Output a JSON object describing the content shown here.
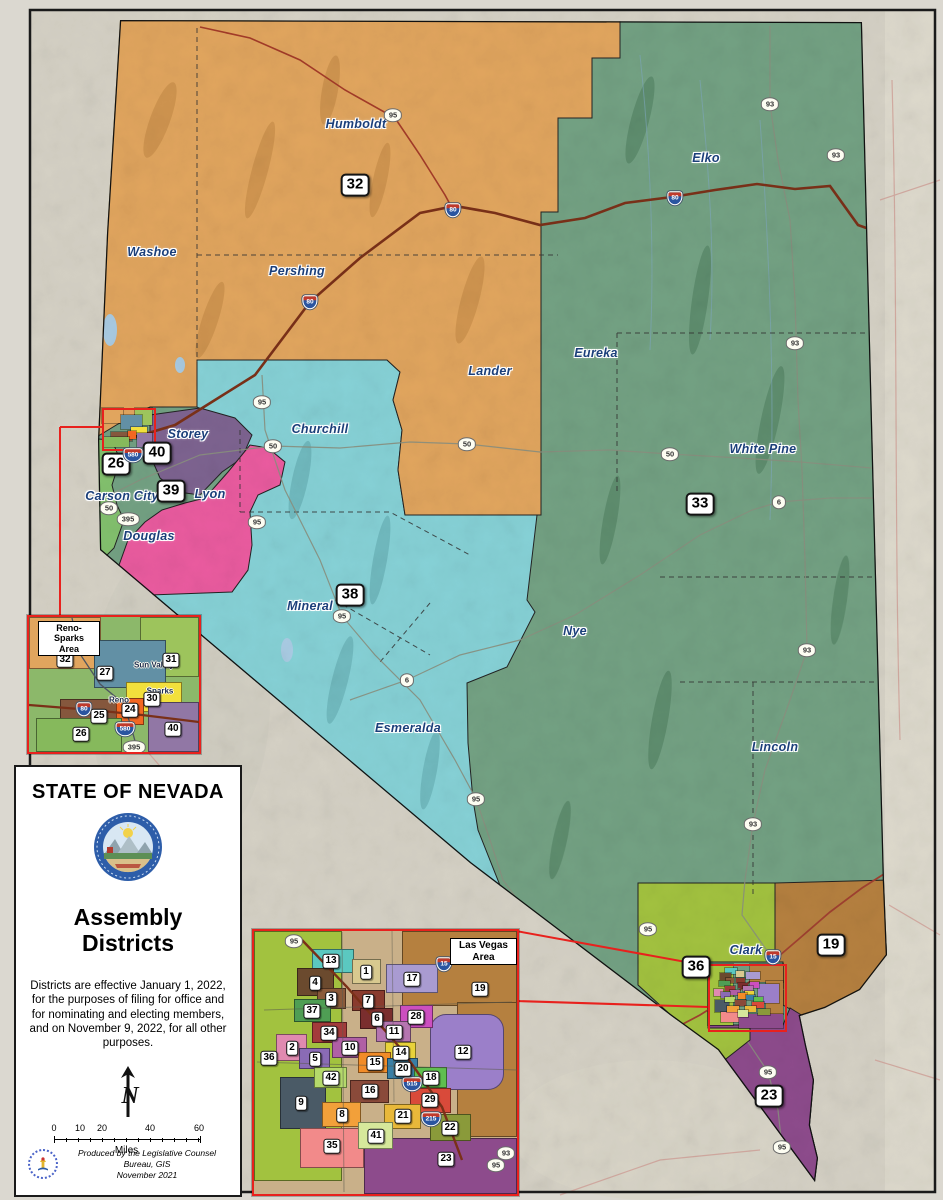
{
  "title_block": {
    "state_title": "STATE OF NEVADA",
    "map_title_line1": "Assembly",
    "map_title_line2": "Districts",
    "note": "Districts are effective January 1, 2022, for the purposes of filing for office and for nominating and electing members, and on November 9, 2022, for all other purposes.",
    "north_label": "N",
    "scale_ticks": [
      {
        "t": "0",
        "x": 38
      },
      {
        "t": "10",
        "x": 64
      },
      {
        "t": "20",
        "x": 86
      },
      {
        "t": "40",
        "x": 134
      },
      {
        "t": "60",
        "x": 183
      }
    ],
    "scale_unit": "Miles",
    "credit_line1": "Produced by the Legislative Counsel Bureau, GIS",
    "credit_line2": "November 2021"
  },
  "main_map": {
    "county_labels": [
      {
        "text": "Humboldt",
        "x": 356,
        "y": 124
      },
      {
        "text": "Washoe",
        "x": 152,
        "y": 252
      },
      {
        "text": "Pershing",
        "x": 297,
        "y": 271
      },
      {
        "text": "Elko",
        "x": 706,
        "y": 158
      },
      {
        "text": "Lander",
        "x": 490,
        "y": 371
      },
      {
        "text": "Eureka",
        "x": 596,
        "y": 353
      },
      {
        "text": "Churchill",
        "x": 320,
        "y": 429
      },
      {
        "text": "White Pine",
        "x": 763,
        "y": 449
      },
      {
        "text": "Storey",
        "x": 188,
        "y": 434
      },
      {
        "text": "Carson City",
        "x": 122,
        "y": 496
      },
      {
        "text": "Lyon",
        "x": 210,
        "y": 494
      },
      {
        "text": "Douglas",
        "x": 149,
        "y": 536
      },
      {
        "text": "Mineral",
        "x": 310,
        "y": 606
      },
      {
        "text": "Nye",
        "x": 575,
        "y": 631
      },
      {
        "text": "Esmeralda",
        "x": 408,
        "y": 728
      },
      {
        "text": "Lincoln",
        "x": 775,
        "y": 747
      },
      {
        "text": "Clark",
        "x": 746,
        "y": 950
      }
    ],
    "district_badges": [
      {
        "n": "32",
        "x": 355,
        "y": 185
      },
      {
        "n": "26",
        "x": 116,
        "y": 464
      },
      {
        "n": "40",
        "x": 157,
        "y": 453
      },
      {
        "n": "39",
        "x": 171,
        "y": 491
      },
      {
        "n": "38",
        "x": 350,
        "y": 595
      },
      {
        "n": "33",
        "x": 700,
        "y": 504
      },
      {
        "n": "36",
        "x": 696,
        "y": 967
      },
      {
        "n": "19",
        "x": 831,
        "y": 945
      },
      {
        "n": "23",
        "x": 769,
        "y": 1096
      }
    ],
    "shields": [
      {
        "t": "95",
        "k": "us",
        "x": 393,
        "y": 115
      },
      {
        "t": "95",
        "k": "us",
        "x": 262,
        "y": 402
      },
      {
        "t": "95",
        "k": "us",
        "x": 257,
        "y": 522
      },
      {
        "t": "95",
        "k": "us",
        "x": 342,
        "y": 616
      },
      {
        "t": "95",
        "k": "us",
        "x": 476,
        "y": 799
      },
      {
        "t": "95",
        "k": "us",
        "x": 648,
        "y": 929
      },
      {
        "t": "95",
        "k": "us",
        "x": 768,
        "y": 1072
      },
      {
        "t": "95",
        "k": "us",
        "x": 782,
        "y": 1147
      },
      {
        "t": "50",
        "k": "us",
        "x": 109,
        "y": 508
      },
      {
        "t": "50",
        "k": "us",
        "x": 273,
        "y": 446
      },
      {
        "t": "50",
        "k": "us",
        "x": 467,
        "y": 444
      },
      {
        "t": "50",
        "k": "us",
        "x": 670,
        "y": 454
      },
      {
        "t": "93",
        "k": "us",
        "x": 770,
        "y": 104
      },
      {
        "t": "93",
        "k": "us",
        "x": 836,
        "y": 155
      },
      {
        "t": "93",
        "k": "us",
        "x": 795,
        "y": 343
      },
      {
        "t": "93",
        "k": "us",
        "x": 807,
        "y": 650
      },
      {
        "t": "93",
        "k": "us",
        "x": 753,
        "y": 824
      },
      {
        "t": "6",
        "k": "us",
        "x": 407,
        "y": 680
      },
      {
        "t": "6",
        "k": "us",
        "x": 779,
        "y": 502
      },
      {
        "t": "395",
        "k": "us",
        "x": 128,
        "y": 519
      },
      {
        "t": "80",
        "k": "i",
        "x": 310,
        "y": 302
      },
      {
        "t": "80",
        "k": "i",
        "x": 453,
        "y": 210
      },
      {
        "t": "80",
        "k": "i",
        "x": 675,
        "y": 198
      },
      {
        "t": "580",
        "k": "i",
        "x": 133,
        "y": 455
      },
      {
        "t": "15",
        "k": "i",
        "x": 773,
        "y": 957
      }
    ]
  },
  "insets": {
    "reno": {
      "title_line1": "Reno-Sparks",
      "title_line2": "Area",
      "regions": [
        {
          "x": 27,
          "y": 615,
          "w": 72,
          "h": 52,
          "c": "#e1a55e"
        },
        {
          "x": 138,
          "y": 615,
          "w": 59,
          "h": 60,
          "c": "#9dc45c"
        },
        {
          "x": 92,
          "y": 638,
          "w": 72,
          "h": 48,
          "c": "#6290a5"
        },
        {
          "x": 124,
          "y": 680,
          "w": 56,
          "h": 30,
          "c": "#f2e03c"
        },
        {
          "x": 58,
          "y": 697,
          "w": 70,
          "h": 32,
          "c": "#85573d"
        },
        {
          "x": 114,
          "y": 696,
          "w": 28,
          "h": 27,
          "c": "#f26722"
        },
        {
          "x": 34,
          "y": 716,
          "w": 86,
          "h": 34,
          "c": "#86b95c"
        },
        {
          "x": 146,
          "y": 700,
          "w": 51,
          "h": 50,
          "c": "#9177a5"
        }
      ],
      "badges": [
        {
          "n": "32",
          "x": 63,
          "y": 658
        },
        {
          "n": "27",
          "x": 103,
          "y": 671
        },
        {
          "n": "31",
          "x": 169,
          "y": 658
        },
        {
          "n": "30",
          "x": 150,
          "y": 697
        },
        {
          "n": "24",
          "x": 128,
          "y": 708
        },
        {
          "n": "25",
          "x": 97,
          "y": 714
        },
        {
          "n": "26",
          "x": 79,
          "y": 732
        },
        {
          "n": "40",
          "x": 171,
          "y": 727
        }
      ],
      "city_labels": [
        {
          "text": "Sun Valley",
          "x": 152,
          "y": 663
        },
        {
          "text": "Sparks",
          "x": 158,
          "y": 689
        },
        {
          "text": "Reno",
          "x": 117,
          "y": 698
        }
      ],
      "shields": [
        {
          "t": "395",
          "k": "us",
          "x": 68,
          "y": 642
        },
        {
          "t": "80",
          "k": "i",
          "x": 82,
          "y": 707
        },
        {
          "t": "580",
          "k": "i",
          "x": 123,
          "y": 727
        },
        {
          "t": "395",
          "k": "us",
          "x": 132,
          "y": 745
        }
      ]
    },
    "vegas": {
      "title": "Las Vegas Area",
      "regions": [
        {
          "x": 252,
          "y": 929,
          "w": 88,
          "h": 250,
          "c": "#a2c23f"
        },
        {
          "x": 400,
          "y": 929,
          "w": 115,
          "h": 75,
          "c": "#b5803f"
        },
        {
          "x": 455,
          "y": 1000,
          "w": 60,
          "h": 135,
          "c": "#b5803f"
        },
        {
          "x": 278,
          "y": 1075,
          "w": 46,
          "h": 52,
          "c": "#4a5a66"
        },
        {
          "x": 298,
          "y": 1126,
          "w": 64,
          "h": 40,
          "c": "#f28a8a"
        },
        {
          "x": 362,
          "y": 1136,
          "w": 153,
          "h": 56,
          "c": "#8d4b8c"
        },
        {
          "x": 428,
          "y": 1012,
          "w": 74,
          "h": 76,
          "c": "#9b7fc9",
          "r": 16
        },
        {
          "x": 310,
          "y": 947,
          "w": 42,
          "h": 24,
          "c": "#5bc8c0"
        },
        {
          "x": 350,
          "y": 957,
          "w": 29,
          "h": 25,
          "c": "#d8c98f"
        },
        {
          "x": 295,
          "y": 966,
          "w": 37,
          "h": 28,
          "c": "#6b4a2e"
        },
        {
          "x": 384,
          "y": 962,
          "w": 52,
          "h": 29,
          "c": "#a99bd1"
        },
        {
          "x": 315,
          "y": 986,
          "w": 29,
          "h": 21,
          "c": "#8a5a3a"
        },
        {
          "x": 350,
          "y": 988,
          "w": 33,
          "h": 21,
          "c": "#8a3b2e"
        },
        {
          "x": 292,
          "y": 997,
          "w": 37,
          "h": 23,
          "c": "#4f9e54"
        },
        {
          "x": 358,
          "y": 1006,
          "w": 33,
          "h": 21,
          "c": "#7a2e2e"
        },
        {
          "x": 398,
          "y": 1003,
          "w": 33,
          "h": 23,
          "c": "#cc4fc0"
        },
        {
          "x": 310,
          "y": 1020,
          "w": 35,
          "h": 21,
          "c": "#a33b3b"
        },
        {
          "x": 374,
          "y": 1019,
          "w": 35,
          "h": 21,
          "c": "#b575b0"
        },
        {
          "x": 274,
          "y": 1032,
          "w": 31,
          "h": 27,
          "c": "#e08ab0"
        },
        {
          "x": 330,
          "y": 1035,
          "w": 35,
          "h": 21,
          "c": "#b05fa5"
        },
        {
          "x": 383,
          "y": 1040,
          "w": 31,
          "h": 21,
          "c": "#e8d23a"
        },
        {
          "x": 297,
          "y": 1046,
          "w": 31,
          "h": 21,
          "c": "#8a6bb5"
        },
        {
          "x": 356,
          "y": 1050,
          "w": 33,
          "h": 21,
          "c": "#f28c28"
        },
        {
          "x": 385,
          "y": 1056,
          "w": 31,
          "h": 21,
          "c": "#3a7fa5"
        },
        {
          "x": 312,
          "y": 1065,
          "w": 33,
          "h": 21,
          "c": "#b5d96b"
        },
        {
          "x": 412,
          "y": 1065,
          "w": 33,
          "h": 21,
          "c": "#5fbf4f"
        },
        {
          "x": 348,
          "y": 1078,
          "w": 39,
          "h": 23,
          "c": "#8a4a3a"
        },
        {
          "x": 408,
          "y": 1086,
          "w": 41,
          "h": 25,
          "c": "#d94a3a"
        },
        {
          "x": 320,
          "y": 1100,
          "w": 39,
          "h": 25,
          "c": "#f2a03a"
        },
        {
          "x": 382,
          "y": 1102,
          "w": 37,
          "h": 25,
          "c": "#e8b83a"
        },
        {
          "x": 428,
          "y": 1112,
          "w": 41,
          "h": 27,
          "c": "#8a9a3a"
        },
        {
          "x": 356,
          "y": 1120,
          "w": 35,
          "h": 27,
          "c": "#d6e89b"
        }
      ],
      "badges": [
        {
          "n": "13",
          "x": 329,
          "y": 959
        },
        {
          "n": "1",
          "x": 364,
          "y": 970
        },
        {
          "n": "4",
          "x": 313,
          "y": 981
        },
        {
          "n": "17",
          "x": 410,
          "y": 977
        },
        {
          "n": "19",
          "x": 478,
          "y": 987
        },
        {
          "n": "3",
          "x": 329,
          "y": 997
        },
        {
          "n": "7",
          "x": 366,
          "y": 999
        },
        {
          "n": "37",
          "x": 310,
          "y": 1009
        },
        {
          "n": "6",
          "x": 375,
          "y": 1017
        },
        {
          "n": "28",
          "x": 414,
          "y": 1015
        },
        {
          "n": "34",
          "x": 327,
          "y": 1031
        },
        {
          "n": "11",
          "x": 392,
          "y": 1030
        },
        {
          "n": "2",
          "x": 290,
          "y": 1046
        },
        {
          "n": "10",
          "x": 348,
          "y": 1046
        },
        {
          "n": "14",
          "x": 399,
          "y": 1051
        },
        {
          "n": "12",
          "x": 461,
          "y": 1050
        },
        {
          "n": "36",
          "x": 267,
          "y": 1056
        },
        {
          "n": "5",
          "x": 313,
          "y": 1057
        },
        {
          "n": "15",
          "x": 373,
          "y": 1061
        },
        {
          "n": "20",
          "x": 401,
          "y": 1067
        },
        {
          "n": "42",
          "x": 329,
          "y": 1076
        },
        {
          "n": "18",
          "x": 429,
          "y": 1076
        },
        {
          "n": "16",
          "x": 368,
          "y": 1089
        },
        {
          "n": "9",
          "x": 299,
          "y": 1101
        },
        {
          "n": "29",
          "x": 428,
          "y": 1098
        },
        {
          "n": "8",
          "x": 340,
          "y": 1113
        },
        {
          "n": "21",
          "x": 401,
          "y": 1114
        },
        {
          "n": "22",
          "x": 448,
          "y": 1126
        },
        {
          "n": "41",
          "x": 374,
          "y": 1134
        },
        {
          "n": "35",
          "x": 330,
          "y": 1144
        },
        {
          "n": "23",
          "x": 444,
          "y": 1157
        }
      ],
      "shields": [
        {
          "t": "95",
          "k": "us",
          "x": 292,
          "y": 939
        },
        {
          "t": "15",
          "k": "i",
          "x": 442,
          "y": 962
        },
        {
          "t": "515",
          "k": "i",
          "x": 410,
          "y": 1082
        },
        {
          "t": "215",
          "k": "i",
          "x": 429,
          "y": 1117
        },
        {
          "t": "93",
          "k": "us",
          "x": 504,
          "y": 1151
        },
        {
          "t": "95",
          "k": "us",
          "x": 494,
          "y": 1163
        }
      ]
    }
  }
}
